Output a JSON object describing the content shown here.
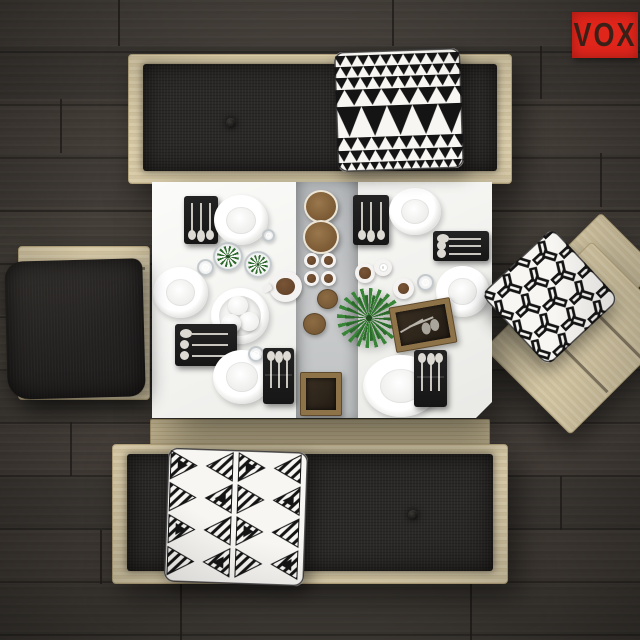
{
  "logo": {
    "text": "VOX",
    "background": "#e0251b",
    "color": "#2e2018"
  },
  "palette": {
    "floor": "#403b36",
    "floor_seam": "#23201d",
    "wood": "#d8cba8",
    "wood_rail": "#c9bb93",
    "cushion": "#2b2927",
    "table": "#f5f4f2",
    "runner": "#bcbfc1",
    "pillow_black": "#141414",
    "pillow_white": "#f7f6f3",
    "plant_green": "#2f6b2e",
    "fern_green": "#398538",
    "coffee_brown": "#6e4c2f",
    "box_wood": "#8f7348",
    "brand_red": "#e0251b"
  },
  "floor": {
    "patches": [
      {
        "x": 0,
        "y": 0,
        "w": 640,
        "h": 46,
        "c": "#4a443d",
        "o": 0.5
      },
      {
        "x": 0,
        "y": 46,
        "w": 640,
        "h": 53,
        "c": "#3c3833",
        "o": 0.5
      },
      {
        "x": 0,
        "y": 99,
        "w": 640,
        "h": 54,
        "c": "#4d463e",
        "o": 0.4
      },
      {
        "x": 0,
        "y": 153,
        "w": 640,
        "h": 54,
        "c": "#413c37",
        "o": 0.5
      },
      {
        "x": 0,
        "y": 207,
        "w": 640,
        "h": 54,
        "c": "#4a443c",
        "o": 0.35
      },
      {
        "x": 0,
        "y": 261,
        "w": 640,
        "h": 54,
        "c": "#3b3732",
        "o": 0.5
      },
      {
        "x": 0,
        "y": 315,
        "w": 640,
        "h": 54,
        "c": "#4b453d",
        "o": 0.4
      },
      {
        "x": 0,
        "y": 369,
        "w": 640,
        "h": 53,
        "c": "#403b36",
        "o": 0.5
      },
      {
        "x": 0,
        "y": 422,
        "w": 640,
        "h": 54,
        "c": "#4c463e",
        "o": 0.35
      },
      {
        "x": 0,
        "y": 476,
        "w": 640,
        "h": 54,
        "c": "#3c3833",
        "o": 0.5
      },
      {
        "x": 0,
        "y": 530,
        "w": 640,
        "h": 54,
        "c": "#4a443c",
        "o": 0.4
      },
      {
        "x": 0,
        "y": 584,
        "w": 640,
        "h": 56,
        "c": "#423d37",
        "o": 0.5
      }
    ],
    "seams": [
      {
        "x": 118,
        "y": 0,
        "h": 46
      },
      {
        "x": 392,
        "y": 0,
        "h": 46
      },
      {
        "x": 540,
        "y": 46,
        "h": 53
      },
      {
        "x": 60,
        "y": 99,
        "h": 54
      },
      {
        "x": 600,
        "y": 153,
        "h": 54
      },
      {
        "x": 40,
        "y": 315,
        "h": 54
      },
      {
        "x": 70,
        "y": 422,
        "h": 54
      },
      {
        "x": 560,
        "y": 476,
        "h": 54
      },
      {
        "x": 100,
        "y": 530,
        "h": 54
      },
      {
        "x": 180,
        "y": 584,
        "h": 56
      },
      {
        "x": 470,
        "y": 584,
        "h": 56
      }
    ]
  },
  "scene": {
    "pillows": [
      {
        "name": "pillow-triangle-pattern",
        "style": "triangles",
        "x": 336,
        "y": 50,
        "w": 126,
        "h": 120,
        "rot": -2
      },
      {
        "name": "pillow-solid-dark",
        "style": "plain",
        "x": 6,
        "y": 260,
        "w": 138,
        "h": 138,
        "rot": -1.5
      },
      {
        "name": "pillow-y-geometric",
        "style": "ygrid",
        "x": 501,
        "y": 248,
        "w": 98,
        "h": 98,
        "rot": 47
      },
      {
        "name": "pillow-tribal-triangles",
        "style": "tribal",
        "x": 166,
        "y": 450,
        "w": 140,
        "h": 134,
        "rot": 2
      }
    ],
    "tableware": [
      {
        "type": "tray",
        "o": "v",
        "heads": "bottom",
        "x": 32,
        "y": 14,
        "w": 34,
        "h": 48
      },
      {
        "type": "plate",
        "x": 62,
        "y": 13,
        "w": 54,
        "h": 50
      },
      {
        "type": "succulent",
        "x": 61,
        "y": 60,
        "w": 30,
        "h": 29
      },
      {
        "type": "succulent",
        "x": 92,
        "y": 69,
        "w": 28,
        "h": 27
      },
      {
        "type": "glass",
        "x": 45,
        "y": 77,
        "w": 17,
        "h": 17
      },
      {
        "type": "glass",
        "x": 110,
        "y": 47,
        "w": 13,
        "h": 13
      },
      {
        "type": "mug",
        "x": 117,
        "y": 89,
        "w": 33,
        "h": 31
      },
      {
        "type": "plate",
        "x": 1,
        "y": 85,
        "w": 55,
        "h": 51
      },
      {
        "type": "eggs-bowl",
        "x": 59,
        "y": 106,
        "w": 58,
        "h": 56
      },
      {
        "type": "tray",
        "o": "h",
        "heads": "left",
        "x": 23,
        "y": 142,
        "w": 62,
        "h": 42
      },
      {
        "type": "plate",
        "x": 61,
        "y": 168,
        "w": 58,
        "h": 54
      },
      {
        "type": "glass",
        "x": 96,
        "y": 164,
        "w": 16,
        "h": 16
      },
      {
        "type": "tray",
        "o": "v",
        "heads": "top",
        "pouch": true,
        "x": 111,
        "y": 166,
        "w": 31,
        "h": 56
      },
      {
        "type": "board",
        "x": 152,
        "y": 8,
        "w": 34,
        "h": 33
      },
      {
        "type": "board",
        "x": 151,
        "y": 38,
        "w": 36,
        "h": 34
      },
      {
        "type": "coffee-cup",
        "x": 152,
        "y": 71,
        "w": 15,
        "h": 15
      },
      {
        "type": "coffee-cup",
        "x": 169,
        "y": 71,
        "w": 15,
        "h": 15
      },
      {
        "type": "coffee-cup",
        "x": 152,
        "y": 89,
        "w": 15,
        "h": 15
      },
      {
        "type": "coffee-cup",
        "x": 169,
        "y": 89,
        "w": 15,
        "h": 15
      },
      {
        "type": "bun",
        "x": 165,
        "y": 107,
        "w": 21,
        "h": 20
      },
      {
        "type": "bun",
        "x": 151,
        "y": 131,
        "w": 23,
        "h": 22
      },
      {
        "type": "wood-box",
        "x": 148,
        "y": 190,
        "w": 42,
        "h": 44
      },
      {
        "type": "tray",
        "o": "v",
        "heads": "bottom",
        "x": 201,
        "y": 13,
        "w": 36,
        "h": 50
      },
      {
        "type": "plate",
        "x": 237,
        "y": 6,
        "w": 52,
        "h": 47
      },
      {
        "type": "small-cup",
        "x": 203,
        "y": 81,
        "w": 20,
        "h": 20
      },
      {
        "type": "white-cup",
        "x": 222,
        "y": 77,
        "w": 18,
        "h": 17
      },
      {
        "type": "small-cup",
        "x": 241,
        "y": 96,
        "w": 21,
        "h": 21
      },
      {
        "type": "glass",
        "x": 265,
        "y": 92,
        "w": 17,
        "h": 17
      },
      {
        "type": "tray",
        "o": "h",
        "heads": "left",
        "x": 281,
        "y": 49,
        "w": 56,
        "h": 30
      },
      {
        "type": "plate",
        "x": 284,
        "y": 84,
        "w": 53,
        "h": 51
      },
      {
        "type": "fern",
        "x": 185,
        "y": 106,
        "w": 64,
        "h": 60
      },
      {
        "type": "spoon-box",
        "x": 240,
        "y": 120,
        "w": 62,
        "h": 46,
        "rot": -10
      },
      {
        "type": "plate",
        "x": 211,
        "y": 173,
        "w": 76,
        "h": 62
      },
      {
        "type": "tray",
        "o": "v",
        "heads": "top",
        "pouch": true,
        "x": 262,
        "y": 168,
        "w": 33,
        "h": 57
      }
    ]
  }
}
